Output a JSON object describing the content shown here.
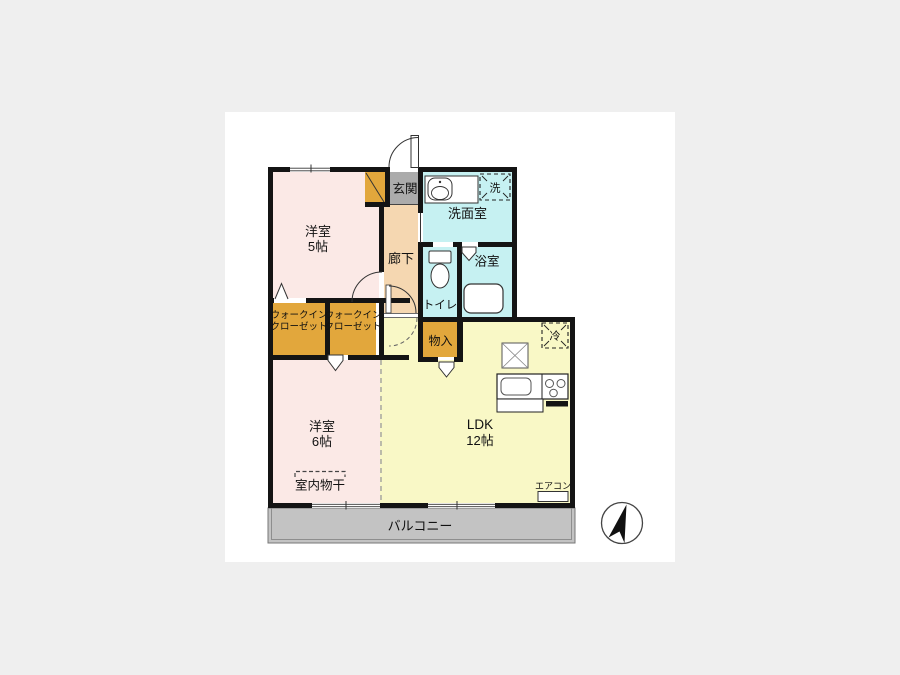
{
  "page": {
    "background_color": "#efefef",
    "canvas_color": "#ffffff"
  },
  "colors": {
    "wall": "#141414",
    "bedroom_pink": "#fbe9e6",
    "closet_orange": "#e2a73c",
    "hallway_peach": "#f5d7b1",
    "entrance_gray": "#ababab",
    "wet_area_cyan": "#c6f1f2",
    "ldk_yellow": "#f9f8c6",
    "balcony_gray": "#c3c3c3"
  },
  "rooms": {
    "bedroom5": {
      "name": "洋室",
      "size": "5帖"
    },
    "bedroom6": {
      "name": "洋室",
      "size": "6帖"
    },
    "ldk": {
      "name": "LDK",
      "size": "12帖"
    },
    "entrance": {
      "label": "玄関"
    },
    "hallway": {
      "label": "廊下"
    },
    "washroom": {
      "label": "洗面室"
    },
    "toilet": {
      "label": "トイレ"
    },
    "bathroom": {
      "label": "浴室"
    },
    "wic_left": {
      "line1": "ウォークイン",
      "line2": "クローゼット"
    },
    "wic_right": {
      "line1": "ウォークイン",
      "line2": "クローゼット"
    },
    "storage": {
      "label": "物入"
    },
    "balcony": {
      "label": "バルコニー"
    }
  },
  "annotations": {
    "washer": "洗",
    "refrigerator": "冷",
    "indoor_drying": "室内物干",
    "aircon": "エアコン"
  },
  "icons": [
    "north-arrow-icon",
    "toilet-icon",
    "bathtub-icon",
    "washbasin-icon",
    "kitchen-sink-icon",
    "stove-icon",
    "door-swing-arc"
  ]
}
